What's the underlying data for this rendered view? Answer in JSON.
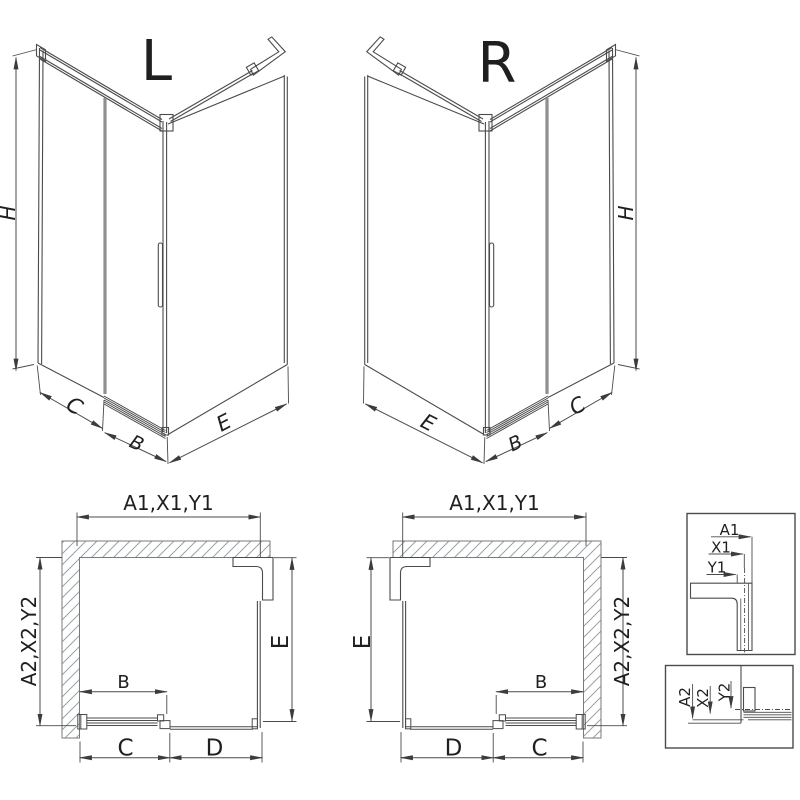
{
  "drawing": {
    "iso_left": {
      "label": "L",
      "dim_height": "H",
      "dim_side": "C",
      "dim_door": "B",
      "dim_front": "E"
    },
    "iso_right": {
      "label": "R",
      "dim_height": "H",
      "dim_side": "C",
      "dim_door": "B",
      "dim_front": "E"
    },
    "plan_left": {
      "dim_top": "A1,X1,Y1",
      "dim_side": "A2,X2,Y2",
      "dim_inner": "E",
      "dim_door": "B",
      "dim_bottom_inner": "C",
      "dim_bottom_outer": "D"
    },
    "plan_right": {
      "dim_top": "A1,X1,Y1",
      "dim_side": "A2,X2,Y2",
      "dim_inner": "E",
      "dim_door": "B",
      "dim_bottom_outer": "D",
      "dim_bottom_inner": "C"
    },
    "detail_top": {
      "dim_a": "A1",
      "dim_x": "X1",
      "dim_y": "Y1"
    },
    "detail_bottom": {
      "dim_a": "A2",
      "dim_x": "X2",
      "dim_y": "Y2"
    }
  },
  "colors": {
    "line": "#4b4b4b",
    "dim": "#3c3c3c",
    "text": "#1f1f1f",
    "hatch": "#9aa3a8",
    "glass_edge": "#8f8f8f",
    "wall_outline": "#7a7a7a",
    "background": "#ffffff"
  }
}
